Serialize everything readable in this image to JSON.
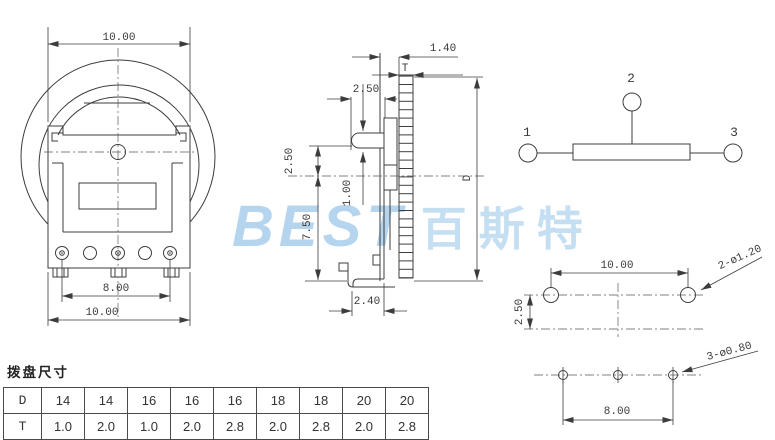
{
  "watermark": {
    "logo": "BEST",
    "cjk": "百斯特",
    "color": "#b5d5ee"
  },
  "front_view": {
    "dim_top": "10.00",
    "dim_pins": "8.00",
    "dim_bottom": "10.00"
  },
  "side_view": {
    "dim_offset": "1.40",
    "thickness_label": "T",
    "dim_lever": "2.50",
    "dim_center": "2.50",
    "dim_axis": "1.00",
    "dim_height": "7.50",
    "dim_foot": "2.40",
    "diameter_label": "D"
  },
  "schematic": {
    "t1": "1",
    "t2": "2",
    "t3": "3"
  },
  "pcb": {
    "dim_hole_spacing": "10.00",
    "dim_row_spacing": "2.50",
    "dim_pin_spacing": "8.00",
    "label_large_holes": "2-ø1.20",
    "label_small_holes": "3-ø0.80"
  },
  "table": {
    "title": "拨盘尺寸",
    "row_d": {
      "label": "D",
      "values": [
        "14",
        "14",
        "16",
        "16",
        "16",
        "18",
        "18",
        "20",
        "20"
      ]
    },
    "row_t": {
      "label": "T",
      "values": [
        "1.0",
        "2.0",
        "1.0",
        "2.0",
        "2.8",
        "2.0",
        "2.8",
        "2.0",
        "2.8"
      ]
    }
  }
}
